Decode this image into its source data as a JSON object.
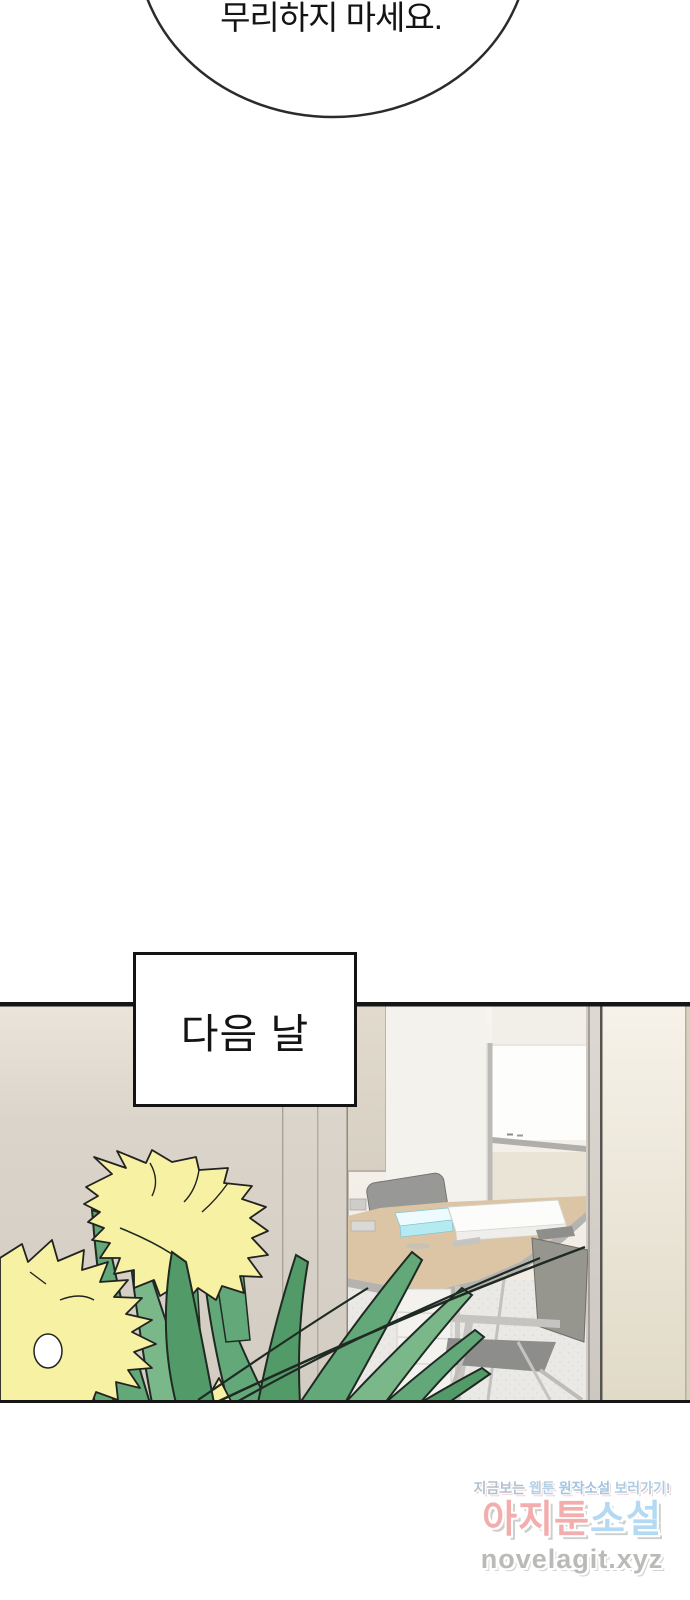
{
  "speech_bubble": {
    "text": "무리하지 마세요."
  },
  "caption_box": {
    "text": "다음 날"
  },
  "palette": {
    "flower_yellow": "#f6f1a3",
    "outline_black": "#222220",
    "leaf_green": "#63a878",
    "leaf_green_light": "#7ab789",
    "leaf_green_dark": "#529a68",
    "stroke_dark": "#1f2b22",
    "desk_tan": "#dcc5a5",
    "desk_edge_gray": "#b5b3af",
    "folder_cyan": "#b4eaf2",
    "chair_gray": "#989896",
    "chair_frame": "#c6c4c0",
    "interior_wall": "#f5f2ec",
    "whiteboard": "#fdfdfb",
    "floor": "#eae9e5",
    "panel_border": "#161616"
  },
  "watermark": {
    "promo": {
      "segments": [
        {
          "text": "지금보는",
          "color": "#a0b2c4"
        },
        {
          "text": "웹툰",
          "color": "#a6c8e0"
        },
        {
          "text": "원작소설",
          "color": "#8fb6da"
        },
        {
          "text": "보러가기!",
          "color": "#9cc0de"
        }
      ]
    },
    "site_name": {
      "segments": [
        {
          "text": "아지툰",
          "color": "#f2a5a5"
        },
        {
          "text": "소설",
          "color": "#abd7f1"
        }
      ]
    },
    "site_url": {
      "text": "novelagit.xyz",
      "color": "#b3b3b1"
    }
  }
}
